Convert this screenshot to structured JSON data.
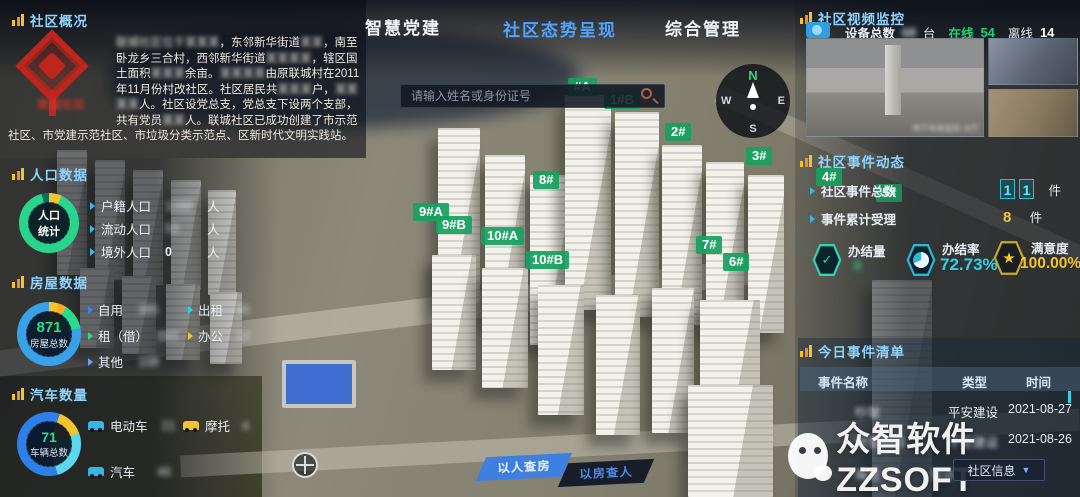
{
  "tabs": [
    {
      "label": "智慧党建",
      "active": false
    },
    {
      "label": "社区态势呈现",
      "active": true
    },
    {
      "label": "综合管理",
      "active": false
    }
  ],
  "search": {
    "placeholder": "请输入姓名或身份证号"
  },
  "overview": {
    "title": "社区概况",
    "logo_caption": "联城社区",
    "segments": [
      {
        "t": "联城社区位于某某某",
        "r": true
      },
      {
        "t": "，东邻新华街道",
        "r": false
      },
      {
        "t": "某某",
        "r": true
      },
      {
        "t": "，南至卧龙乡三合村，西邻新华街道",
        "r": false
      },
      {
        "t": "某某某某",
        "r": true
      },
      {
        "t": "，辖区国土面积",
        "r": false
      },
      {
        "t": "某某某",
        "r": true
      },
      {
        "t": "余亩。",
        "r": false
      },
      {
        "t": "某某某某",
        "r": true
      },
      {
        "t": "由原联城村在2011年11月份村改社区。社区居民共",
        "r": false
      },
      {
        "t": "某某某",
        "r": true
      },
      {
        "t": "户，",
        "r": false
      },
      {
        "t": "某某某某",
        "r": true
      },
      {
        "t": "人。社区设党总支，党总支下设两个支部，共有党员",
        "r": false
      },
      {
        "t": "某某",
        "r": true
      },
      {
        "t": "人。联城社区已成功创建了市示范社区、市党建示范社区、市垃圾分类示范点、区新时代文明实践站。",
        "r": false
      }
    ]
  },
  "population": {
    "title": "人口数据",
    "center_top": "人口",
    "center_bottom": "统计",
    "rows": [
      {
        "label": "户籍人口",
        "value": "1268",
        "unit": "人",
        "redacted": true
      },
      {
        "label": "流动人口",
        "value": "53",
        "unit": "人",
        "redacted": true
      },
      {
        "label": "境外人口",
        "value": "0",
        "unit": "人",
        "redacted": false
      }
    ]
  },
  "housing": {
    "title": "房屋数据",
    "total": "871",
    "total_label": "房屋总数",
    "col1": [
      {
        "label": "自用",
        "value": "385"
      },
      {
        "label": "租（借）",
        "value": "333"
      },
      {
        "label": "其他",
        "value": "108"
      }
    ],
    "col2": [
      {
        "label": "出租",
        "value": "45"
      },
      {
        "label": "办公",
        "value": "12"
      }
    ]
  },
  "vehicles": {
    "title": "汽车数量",
    "total": "71",
    "total_label": "车辆总数",
    "items": [
      {
        "label": "电动车",
        "value": "21"
      },
      {
        "label": "摩托",
        "value": "4"
      },
      {
        "label": "汽车",
        "value": "46"
      }
    ]
  },
  "video": {
    "title": "社区视频监控",
    "device_label": "设备总数",
    "device_value": "68",
    "device_unit": "台",
    "online_label": "在线",
    "online_value": "54",
    "offline_label": "离线",
    "offline_value": "14",
    "caption": "地下车库监控-大厅"
  },
  "events": {
    "title": "社区事件动态",
    "total_label": "社区事件总数",
    "total_digits": [
      "1",
      "1"
    ],
    "total_unit": "件",
    "accepted_label": "事件累计受理",
    "accepted_value": "8",
    "accepted_unit": "件",
    "stats": [
      {
        "label": "办结量",
        "value": "8"
      },
      {
        "label": "办结率",
        "value": "72.73%"
      },
      {
        "label": "满意度",
        "value": "100.00%"
      }
    ]
  },
  "today": {
    "title": "今日事件清单",
    "columns": [
      "事件名称",
      "类型",
      "时间"
    ],
    "rows": [
      [
        "吵架",
        "平安建设",
        "2021-08-27"
      ],
      [
        "邻里纠纷",
        "平安建设",
        "2021-08-26"
      ],
      [
        "噪音",
        "信访",
        ""
      ]
    ],
    "footer_select": "社区信息"
  },
  "map": {
    "labels": [
      "#A",
      "1#B",
      "2#",
      "3#",
      "8#",
      "9#A",
      "9#B",
      "10#A",
      "10#B",
      "7#",
      "6#",
      "4#",
      "5#"
    ],
    "compass": {
      "n": "N",
      "w": "W",
      "e": "E",
      "s": "S"
    }
  },
  "actions": {
    "by_person": "以人查房",
    "by_house": "以房查人"
  },
  "watermark": {
    "text": "众智软件ZZSOFT"
  },
  "colors": {
    "accent_cyan": "#35cfe8",
    "accent_green": "#2adb8e",
    "accent_yellow": "#f2c430",
    "badge_green": "#16a260",
    "tab_active": "#4da3ff"
  }
}
